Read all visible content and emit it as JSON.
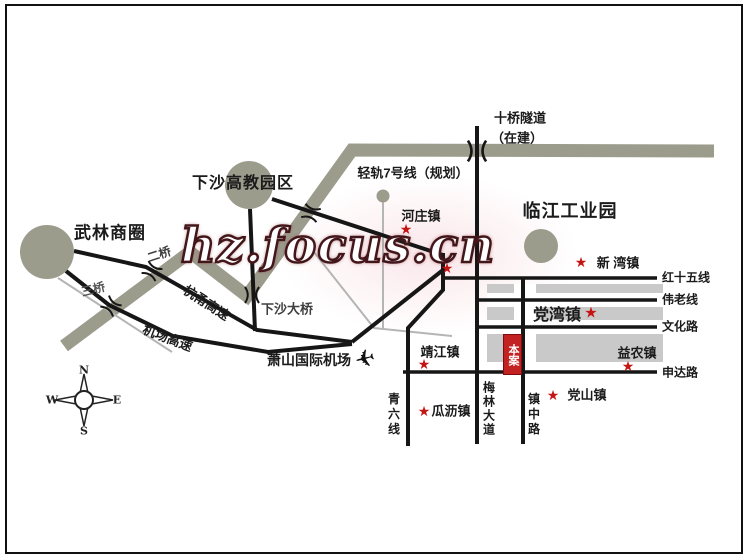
{
  "watermark": "hz.focus.cn",
  "landmarks": [
    {
      "name": "wulin-business-district",
      "label": "武林商圈"
    },
    {
      "name": "xiasha-higher-education-park",
      "label": "下沙高教园区"
    },
    {
      "name": "linjiang-industrial-park",
      "label": "临江工业园"
    }
  ],
  "project_marker": {
    "label": "本案"
  },
  "towns": [
    {
      "name": "hezhuang-town",
      "label": "河庄镇"
    },
    {
      "name": "xinwan-town",
      "label": "新 湾镇"
    },
    {
      "name": "dangwan-town",
      "label": "党湾镇"
    },
    {
      "name": "yinong-town",
      "label": "益农镇"
    },
    {
      "name": "dangshan-town",
      "label": "党山镇"
    },
    {
      "name": "guali-town",
      "label": "瓜沥镇"
    },
    {
      "name": "jingjiang-town",
      "label": "靖江镇"
    }
  ],
  "roads": [
    {
      "name": "hangyong-expressway",
      "label": "杭甬高速"
    },
    {
      "name": "airport-expressway",
      "label": "机场高速"
    },
    {
      "name": "hongshiwu-line",
      "label": "红十五线"
    },
    {
      "name": "weilao-line",
      "label": "伟老线"
    },
    {
      "name": "wenhua-road",
      "label": "文化路"
    },
    {
      "name": "shenda-road",
      "label": "申达路"
    },
    {
      "name": "qingliu-line",
      "label": "青六线"
    },
    {
      "name": "meilin-avenue",
      "label": "梅林大道"
    },
    {
      "name": "zhenzhong-road",
      "label": "镇中路"
    }
  ],
  "bridges": [
    {
      "name": "second-bridge",
      "label": "二桥"
    },
    {
      "name": "third-bridge",
      "label": "三桥"
    },
    {
      "name": "xiasha-bridge",
      "label": "下沙大桥"
    },
    {
      "name": "shiqiao-tunnel",
      "label": "十桥隧道",
      "status": "（在建）"
    }
  ],
  "transit": {
    "line7_label": "轻轨7号线（规划）"
  },
  "airport": {
    "label": "萧山国际机场"
  },
  "compass": {
    "north": "N",
    "south": "S",
    "east": "E",
    "west": "W"
  },
  "icons": {
    "star": "★",
    "airplane": "✈"
  },
  "colors": {
    "river": "#9C9C8D",
    "road": "#161616",
    "shade": "#C9C9C9",
    "star_red": "#C41414",
    "project_red": "#C32222"
  }
}
